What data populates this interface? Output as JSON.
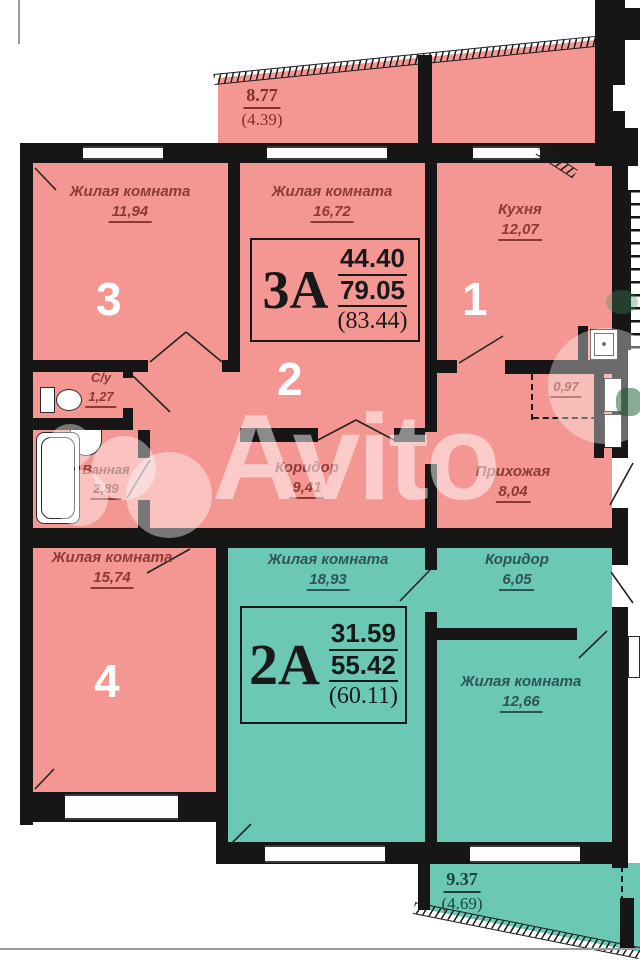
{
  "apartments": {
    "a3": {
      "code": "3А",
      "living": "44.40",
      "total": "79.05",
      "with_balcony": "(83.44)"
    },
    "a2": {
      "code": "2А",
      "living": "31.59",
      "total": "55.42",
      "with_balcony": "(60.11)"
    }
  },
  "rooms": {
    "room3": {
      "name": "Жилая комната",
      "area": "11,94",
      "number": "3"
    },
    "room2": {
      "name": "Жилая комната",
      "area": "16,72",
      "number": "2"
    },
    "kitchen": {
      "name": "Кухня",
      "area": "12,07",
      "number": "1"
    },
    "wc": {
      "name": "С/у",
      "area": "1,27"
    },
    "bath": {
      "name": "Ванная",
      "area": "2,89"
    },
    "corridor_3a": {
      "name": "Коридор",
      "area": "9,41"
    },
    "hallway": {
      "name": "Прихожая",
      "area": "8,04"
    },
    "niche": {
      "area": "0,97"
    },
    "room4": {
      "name": "Жилая комната",
      "area": "15,74",
      "number": "4"
    },
    "room2a_big": {
      "name": "Жилая комната",
      "area": "18,93"
    },
    "corridor_2a": {
      "name": "Коридор",
      "area": "6,05"
    },
    "room2a_small": {
      "name": "Жилая комната",
      "area": "12,66"
    }
  },
  "balconies": {
    "top": {
      "area": "8.77",
      "reduced": "(4.39)"
    },
    "bottom": {
      "area": "9.37",
      "reduced": "(4.69)"
    }
  },
  "watermark": {
    "text": "Avito"
  },
  "colors": {
    "apartment_3a": "#f49692",
    "apartment_2a": "#6ac8b4",
    "wall": "#161616",
    "label_3a": "#8d3a34",
    "label_2a": "#2f5458"
  }
}
